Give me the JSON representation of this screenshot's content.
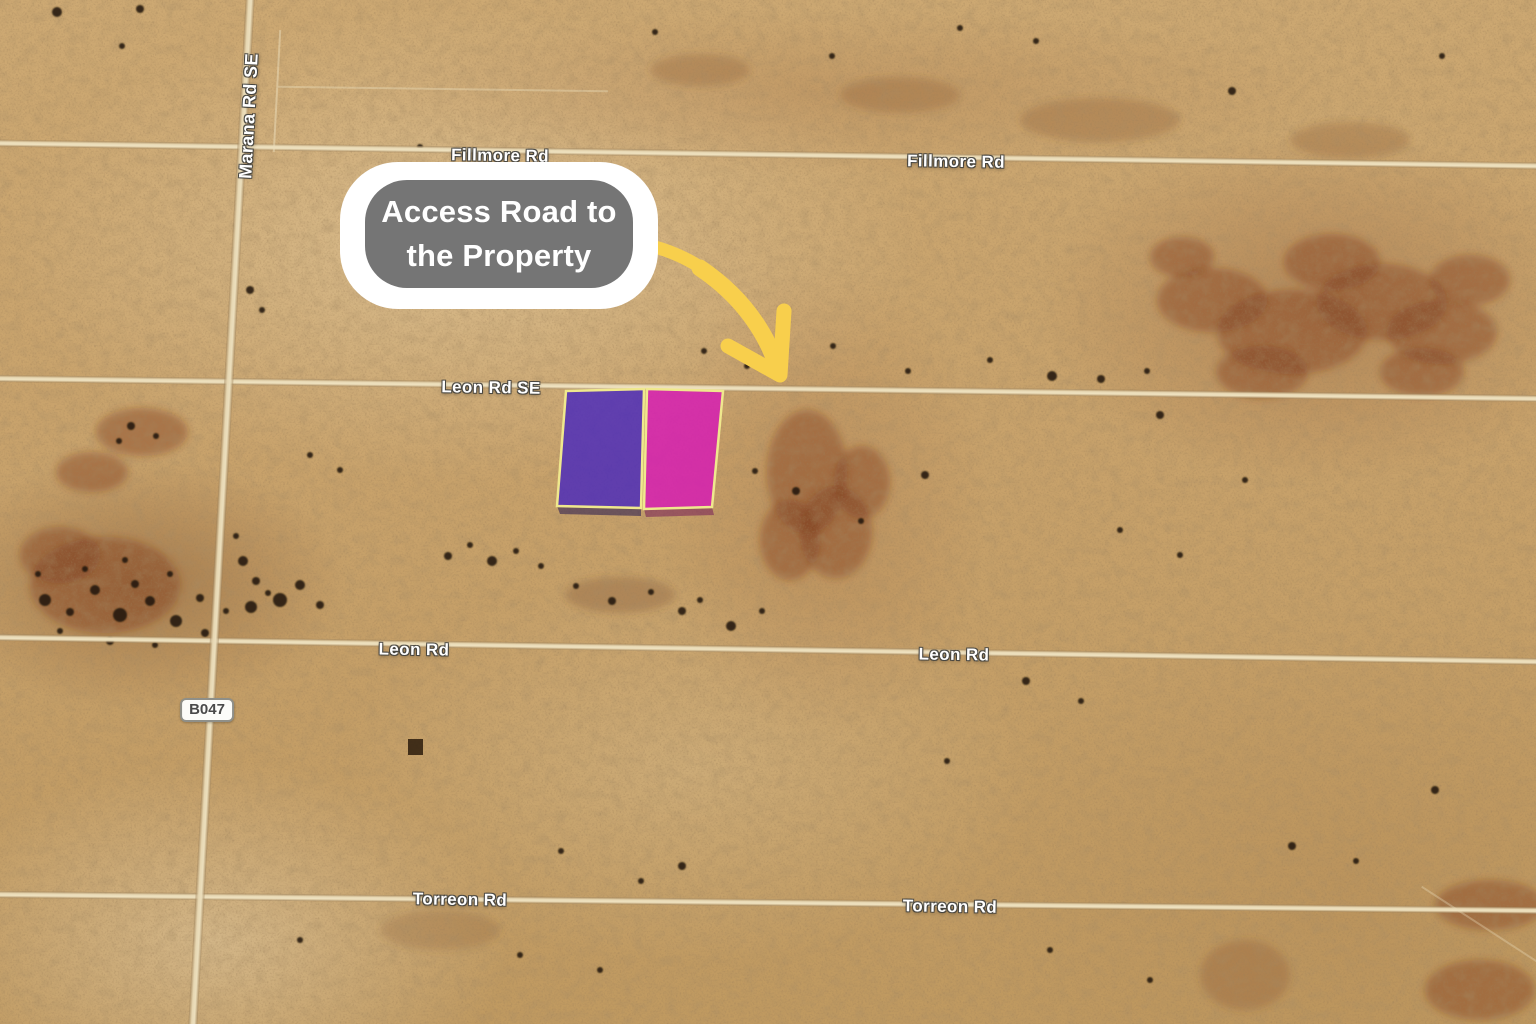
{
  "map": {
    "view": "satellite-desert",
    "terrain_color": "#C9A36E",
    "road_labels": [
      {
        "id": "fillmore-west",
        "text": "Fillmore Rd"
      },
      {
        "id": "fillmore-east",
        "text": "Fillmore Rd"
      },
      {
        "id": "marana",
        "text": "Marana Rd SE"
      },
      {
        "id": "leon-se",
        "text": "Leon Rd SE"
      },
      {
        "id": "leon-west",
        "text": "Leon Rd"
      },
      {
        "id": "leon-east",
        "text": "Leon Rd"
      },
      {
        "id": "torreon-west",
        "text": "Torreon Rd"
      },
      {
        "id": "torreon-east",
        "text": "Torreon Rd"
      }
    ],
    "route_badge": {
      "text": "B047"
    },
    "callout": {
      "line1": "Access Road to",
      "line2": "the Property",
      "bubble_color": "#757575",
      "ring_color": "#FFFFFF",
      "text_color": "#FFFFFF"
    },
    "arrow": {
      "color": "#F8CF4C",
      "style": "curved-tapered-arrow"
    },
    "parcels": [
      {
        "name": "west-lot",
        "fill": "rgba(70,38,190,0.8)",
        "outline": "#EFE88D"
      },
      {
        "name": "east-lot",
        "fill": "rgba(215,25,180,0.82)",
        "outline": "#EFE88D"
      }
    ]
  }
}
